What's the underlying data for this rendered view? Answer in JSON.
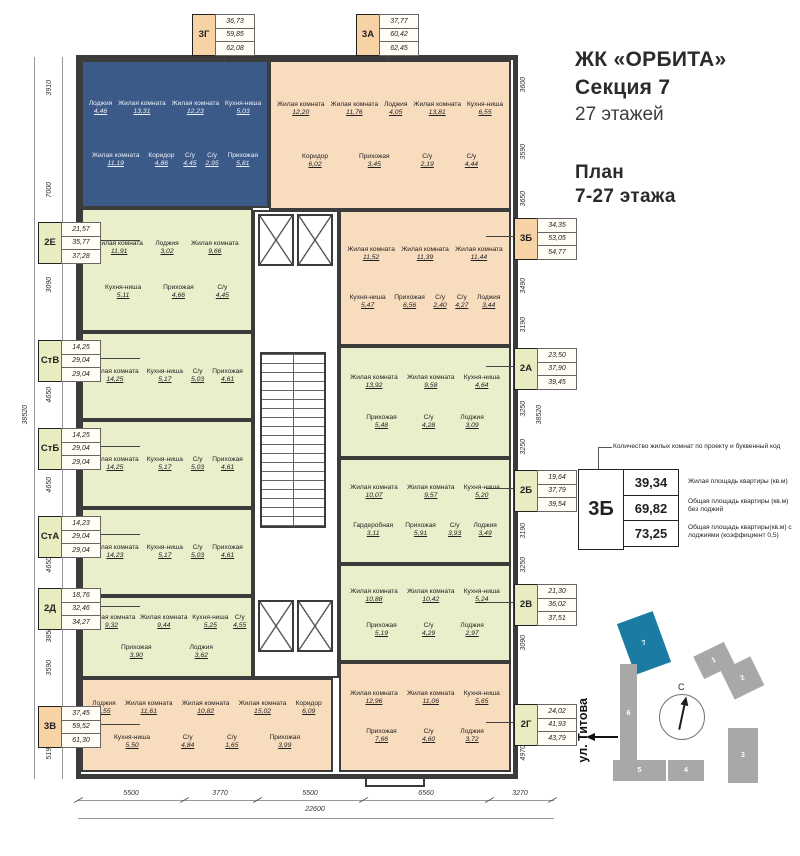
{
  "header": {
    "title": "ЖК «ОРБИТА»",
    "subtitle": "Секция 7",
    "floors": "27 этажей",
    "plan1": "План",
    "plan2": "7-27 этажа"
  },
  "legend": {
    "callout": "Количество жилых комнат по проекту и буквенный код",
    "code": "3Б",
    "v1": "39,34",
    "v2": "69,82",
    "v3": "73,25",
    "d1": "Жилая площадь квартиры (кв.м)",
    "d2": "Общая площадь квартиры (кв.м) без лоджий",
    "d3": "Общая площадь квартиры(кв.м) с лоджиями (коэффициент 0,5)"
  },
  "site": {
    "street": "ул. Титова",
    "north": "С",
    "b1": "1",
    "b2": "2",
    "b3": "3",
    "b4": "4",
    "b5": "5",
    "b6": "6",
    "b7": "7"
  },
  "colors": {
    "wall": "#3b3b3b",
    "apartment_blue": "#3c5a88",
    "apartment_peach": "#f8dcbe",
    "apartment_green": "#ebeecb",
    "tag_peach": "#f7d2a4",
    "tag_green": "#e9ecc0",
    "site_highlight": "#1b7ca3",
    "site_gray": "#a8a8a8"
  },
  "dims": {
    "left": [
      "3910",
      "7000",
      "3090",
      "4650",
      "4650",
      "4650",
      "3850",
      "3590",
      "5190"
    ],
    "left_total": "38520",
    "right": [
      "3600",
      "3590",
      "3650",
      "3490",
      "3190",
      "3250",
      "3250",
      "3190",
      "3250",
      "3090",
      "4970"
    ],
    "right_total": "38520",
    "bottom": [
      "5500",
      "3770",
      "5500",
      "6560",
      "3270"
    ],
    "bottom_total": "22600"
  },
  "apartments": [
    {
      "code": "3Г",
      "areas": [
        "36,73",
        "59,85",
        "62,08"
      ],
      "rooms": [
        {
          "n": "Лоджия",
          "a": "4,46"
        },
        {
          "n": "Жилая комната",
          "a": "13,31"
        },
        {
          "n": "Жилая комната",
          "a": "12,23"
        },
        {
          "n": "Кухня-ниша",
          "a": "5,03"
        },
        {
          "n": "Жилая комната",
          "a": "11,19"
        },
        {
          "n": "Коридор",
          "a": "4,86"
        },
        {
          "n": "С/у",
          "a": "4,45"
        },
        {
          "n": "С/у",
          "a": "2,95"
        },
        {
          "n": "Прихожая",
          "a": "5,81"
        }
      ]
    },
    {
      "code": "3А",
      "areas": [
        "37,77",
        "60,42",
        "62,45"
      ],
      "rooms": [
        {
          "n": "Жилая комната",
          "a": "12,20"
        },
        {
          "n": "Жилая комната",
          "a": "11,76"
        },
        {
          "n": "Лоджия",
          "a": "4,05"
        },
        {
          "n": "Жилая комната",
          "a": "13,81"
        },
        {
          "n": "Кухня-ниша",
          "a": "6,55"
        },
        {
          "n": "Коридор",
          "a": "6,02"
        },
        {
          "n": "Прихожая",
          "a": "3,45"
        },
        {
          "n": "С/у",
          "a": "2,19"
        },
        {
          "n": "С/у",
          "a": "4,44"
        }
      ]
    },
    {
      "code": "2Е",
      "areas": [
        "21,57",
        "35,77",
        "37,28"
      ],
      "rooms": [
        {
          "n": "Жилая комната",
          "a": "11,91"
        },
        {
          "n": "Лоджия",
          "a": "3,02"
        },
        {
          "n": "Жилая комната",
          "a": "9,66"
        },
        {
          "n": "Кухня-ниша",
          "a": "5,11"
        },
        {
          "n": "Прихожая",
          "a": "4,66"
        },
        {
          "n": "С/у",
          "a": "4,45"
        }
      ]
    },
    {
      "code": "СтВ",
      "areas": [
        "14,25",
        "29,04",
        "29,04"
      ],
      "rooms": [
        {
          "n": "Жилая комната",
          "a": "14,25"
        },
        {
          "n": "Кухня-ниша",
          "a": "5,17"
        },
        {
          "n": "С/у",
          "a": "5,03"
        },
        {
          "n": "Прихожая",
          "a": "4,61"
        }
      ]
    },
    {
      "code": "СтБ",
      "areas": [
        "14,25",
        "29,04",
        "29,04"
      ],
      "rooms": [
        {
          "n": "Жилая комната",
          "a": "14,25"
        },
        {
          "n": "Кухня-ниша",
          "a": "5,17"
        },
        {
          "n": "С/у",
          "a": "5,03"
        },
        {
          "n": "Прихожая",
          "a": "4,61"
        }
      ]
    },
    {
      "code": "СтА",
      "areas": [
        "14,23",
        "29,04",
        "29,04"
      ],
      "rooms": [
        {
          "n": "Жилая комната",
          "a": "14,23"
        },
        {
          "n": "Кухня-ниша",
          "a": "5,17"
        },
        {
          "n": "С/у",
          "a": "5,03"
        },
        {
          "n": "Прихожая",
          "a": "4,61"
        }
      ]
    },
    {
      "code": "2Д",
      "areas": [
        "18,76",
        "32,46",
        "34,27"
      ],
      "rooms": [
        {
          "n": "Жилая комната",
          "a": "9,32"
        },
        {
          "n": "Жилая комната",
          "a": "9,44"
        },
        {
          "n": "Кухня-ниша",
          "a": "5,25"
        },
        {
          "n": "С/у",
          "a": "4,55"
        },
        {
          "n": "Прихожая",
          "a": "3,90"
        },
        {
          "n": "Лоджия",
          "a": "3,62"
        }
      ]
    },
    {
      "code": "3В",
      "areas": [
        "37,45",
        "59,52",
        "61,30"
      ],
      "rooms": [
        {
          "n": "Лоджия",
          "a": "3,55"
        },
        {
          "n": "Жилая комната",
          "a": "11,61"
        },
        {
          "n": "Жилая комната",
          "a": "10,82"
        },
        {
          "n": "Жилая комната",
          "a": "15,02"
        },
        {
          "n": "Коридор",
          "a": "6,09"
        },
        {
          "n": "Кухня-ниша",
          "a": "5,50"
        },
        {
          "n": "С/у",
          "a": "4,84"
        },
        {
          "n": "С/у",
          "a": "1,65"
        },
        {
          "n": "Прихожая",
          "a": "3,99"
        }
      ]
    },
    {
      "code": "3Б",
      "areas": [
        "34,35",
        "53,05",
        "54,77"
      ],
      "rooms": [
        {
          "n": "Жилая комната",
          "a": "11,52"
        },
        {
          "n": "Жилая комната",
          "a": "11,39"
        },
        {
          "n": "Жилая комната",
          "a": "11,44"
        },
        {
          "n": "Кухня-ниша",
          "a": "5,47"
        },
        {
          "n": "Прихожая",
          "a": "6,56"
        },
        {
          "n": "С/у",
          "a": "2,40"
        },
        {
          "n": "С/у",
          "a": "4,27"
        },
        {
          "n": "Лоджия",
          "a": "3,44"
        }
      ]
    },
    {
      "code": "2А",
      "areas": [
        "23,50",
        "37,90",
        "39,45"
      ],
      "rooms": [
        {
          "n": "Жилая комната",
          "a": "13,92"
        },
        {
          "n": "Жилая комната",
          "a": "9,58"
        },
        {
          "n": "Кухня-ниша",
          "a": "4,64"
        },
        {
          "n": "Прихожая",
          "a": "5,48"
        },
        {
          "n": "С/у",
          "a": "4,28"
        },
        {
          "n": "Лоджия",
          "a": "3,09"
        }
      ]
    },
    {
      "code": "2Б",
      "areas": [
        "19,64",
        "37,79",
        "39,54"
      ],
      "rooms": [
        {
          "n": "Жилая комната",
          "a": "10,07"
        },
        {
          "n": "Жилая комната",
          "a": "9,57"
        },
        {
          "n": "Кухня-ниша",
          "a": "5,20"
        },
        {
          "n": "Гардеробная",
          "a": "3,11"
        },
        {
          "n": "Прихожая",
          "a": "5,91"
        },
        {
          "n": "С/у",
          "a": "3,93"
        },
        {
          "n": "Лоджия",
          "a": "3,49"
        }
      ]
    },
    {
      "code": "2В",
      "areas": [
        "21,30",
        "36,02",
        "37,51"
      ],
      "rooms": [
        {
          "n": "Жилая комната",
          "a": "10,88"
        },
        {
          "n": "Жилая комната",
          "a": "10,42"
        },
        {
          "n": "Кухня-ниша",
          "a": "5,24"
        },
        {
          "n": "Прихожая",
          "a": "5,19"
        },
        {
          "n": "С/у",
          "a": "4,29"
        },
        {
          "n": "Лоджия",
          "a": "2,97"
        }
      ]
    },
    {
      "code": "2Г",
      "areas": [
        "24,02",
        "41,93",
        "43,79"
      ],
      "rooms": [
        {
          "n": "Жилая комната",
          "a": "12,96"
        },
        {
          "n": "Жилая комната",
          "a": "11,06"
        },
        {
          "n": "Кухня-ниша",
          "a": "5,65"
        },
        {
          "n": "Прихожая",
          "a": "7,66"
        },
        {
          "n": "С/у",
          "a": "4,60"
        },
        {
          "n": "Лоджия",
          "a": "3,72"
        }
      ]
    }
  ]
}
